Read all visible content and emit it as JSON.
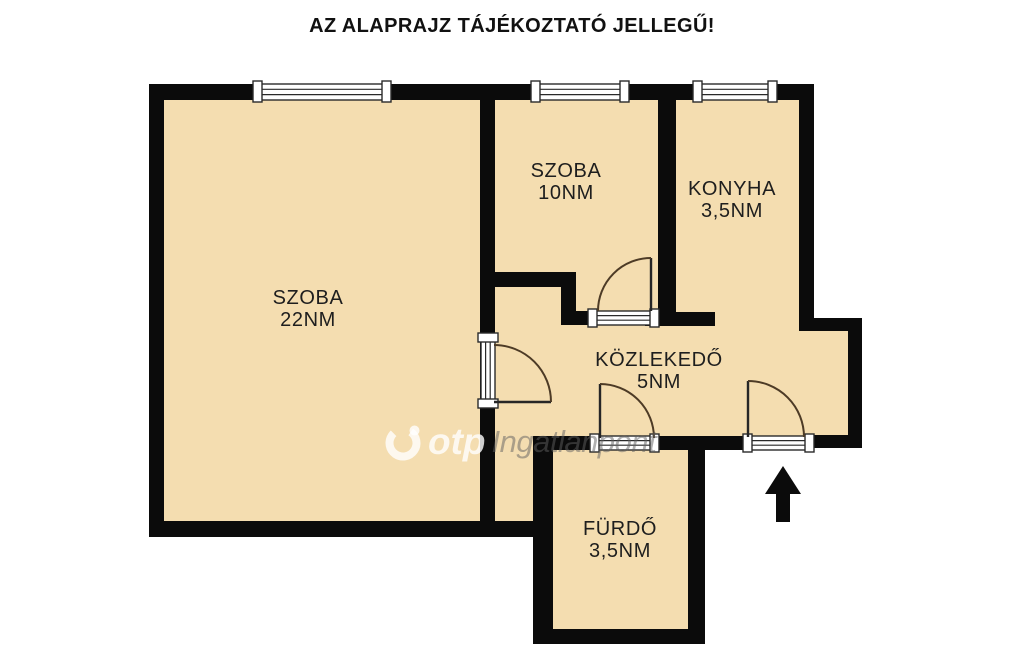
{
  "title": "AZ ALAPRAJZ TÁJÉKOZTATÓ JELLEGŰ!",
  "rooms": [
    {
      "name": "SZOBA",
      "area": "22NM"
    },
    {
      "name": "SZOBA",
      "area": "10NM"
    },
    {
      "name": "KONYHA",
      "area": "3,5NM"
    },
    {
      "name": "KÖZLEKEDŐ",
      "area": "5NM"
    },
    {
      "name": "FÜRDŐ",
      "area": "3,5NM"
    }
  ],
  "watermark": {
    "brand": "otp",
    "name": "Ingatlanpont"
  },
  "colors": {
    "floor": "#F4DDB0",
    "wall": "#0B0B0B",
    "background": "#FFFFFF",
    "watermark_brand": "rgba(255,255,255,0.80)",
    "watermark_name": "rgba(95,95,95,0.50)"
  }
}
